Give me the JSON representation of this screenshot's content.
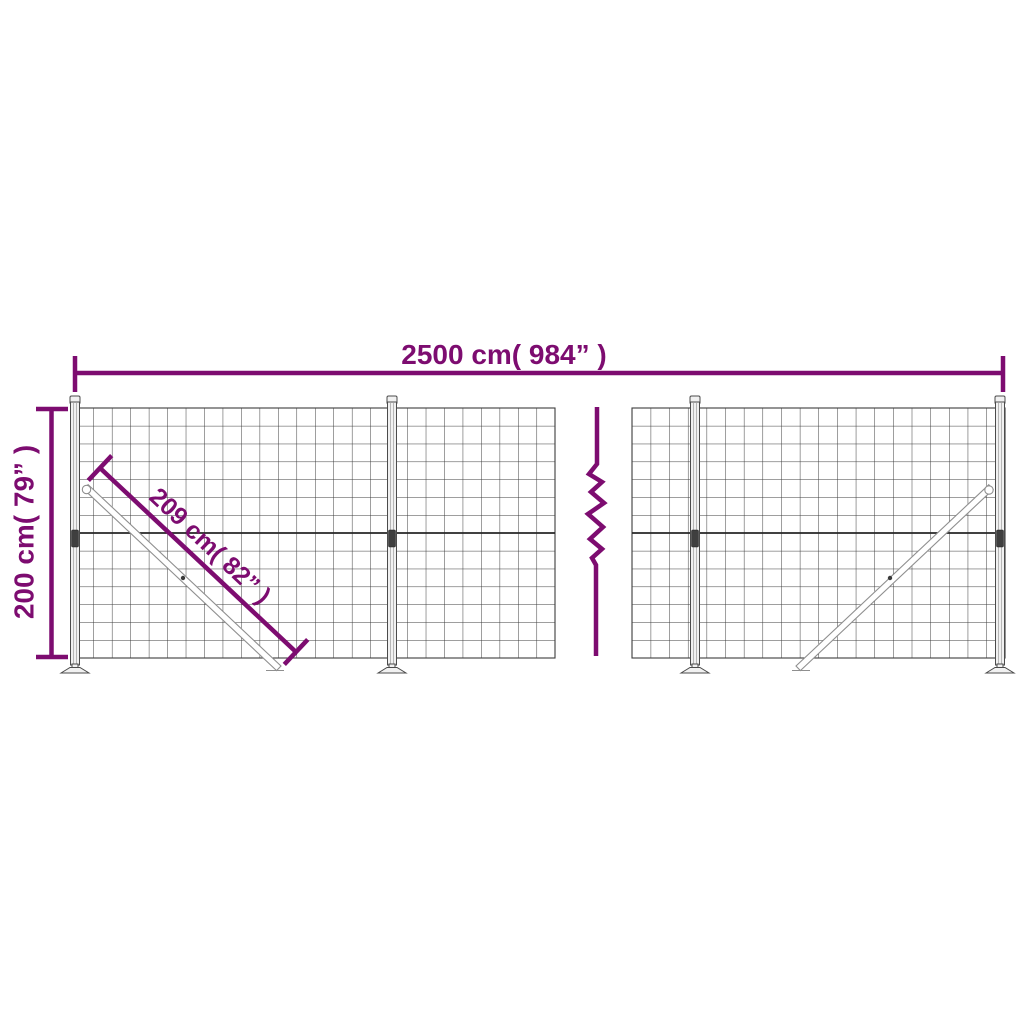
{
  "colors": {
    "accent": "#7d0c70",
    "mesh": "#3c3c3c"
  },
  "labels": {
    "total_width": "2500 cm( 984” )",
    "height": "200 cm( 79” )",
    "brace_length": "209 cm( 82” )"
  }
}
